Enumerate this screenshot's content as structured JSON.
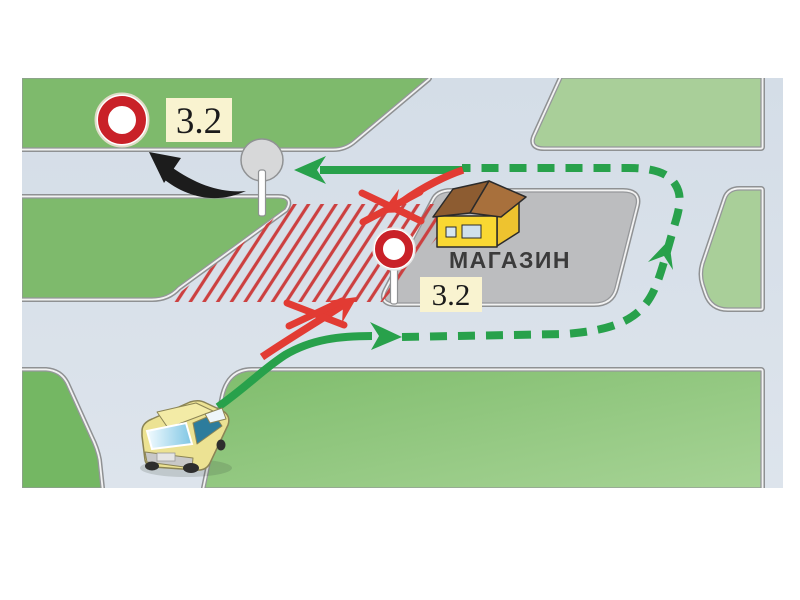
{
  "scene": {
    "type": "traffic-rules-illustration",
    "signs": {
      "roadside_sign": {
        "code": "3.2",
        "kind": "prohibition-circle-sign"
      },
      "island_sign": {
        "code": "3.2",
        "kind": "prohibition-circle-sign"
      }
    },
    "building": {
      "label": "МАГАЗИН"
    },
    "routes": {
      "allowed_color": "#28a14b",
      "prohibited_color": "#e23b33",
      "hatched_zone_color": "#cc4040"
    },
    "colors": {
      "grass_dark": "#7eba6c",
      "grass_light": "#a9cf99",
      "road": "#d8e0e9",
      "island": "#bcbdbf",
      "curb_white": "#f2f2f2",
      "curb_line": "#8f9193",
      "sign_red": "#c92128",
      "label_background": "#f9f3d0",
      "car_body": "#ece293",
      "building_wall": "#f9d832",
      "building_roof": "#a8703c",
      "pointer_black": "#1c1c1c"
    }
  }
}
